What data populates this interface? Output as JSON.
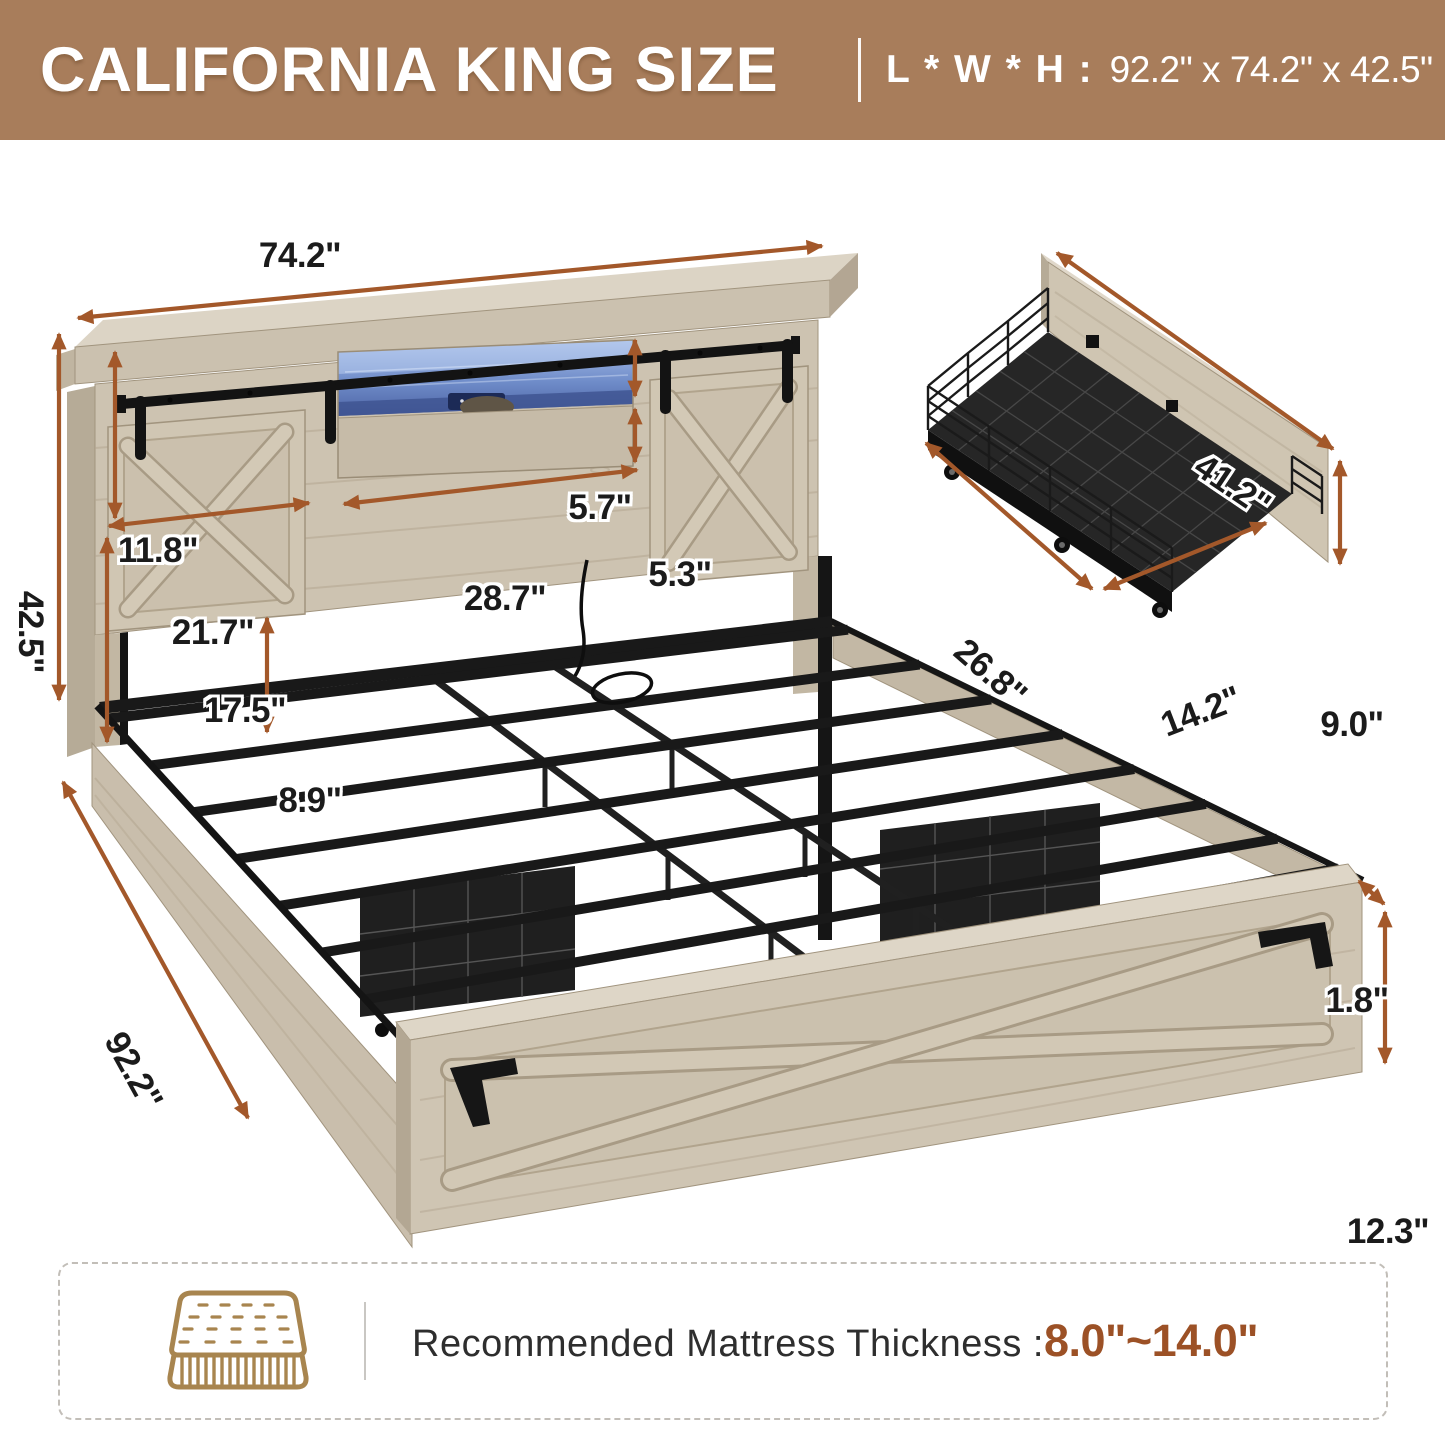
{
  "header": {
    "title": "CALIFORNIA KING SIZE",
    "lwh_label": "L * W * H :",
    "lwh_value": "92.2\" x 74.2\" x 42.5\"",
    "bg_color": "#A87D5B"
  },
  "dimensions": {
    "headboard_width": "74.2\"",
    "total_height": "42.5\"",
    "door_panel_height": "11.8\"",
    "shelf_opening_height": "5.7\"",
    "drawer_front_height": "5.3\"",
    "shelf_opening_width": "28.7\"",
    "door_panel_width": "21.7\"",
    "headboard_lower_height": "17.5\"",
    "underbed_clearance": "8.9\"",
    "bed_length": "92.2\"",
    "footboard_lip": "1.8\"",
    "footboard_height": "12.3\""
  },
  "inset_dimensions": {
    "panel_length": "41.2\"",
    "drawer_depth": "26.8\"",
    "drawer_width": "14.2\"",
    "panel_height": "9.0\""
  },
  "footer": {
    "icon": "mattress-icon",
    "label": "Recommended Mattress Thickness : ",
    "value": "8.0\"~14.0\""
  },
  "colors": {
    "arrow": "#A3582A",
    "accent_value": "#9C5126",
    "wood": "#CBC1AF",
    "wood_dark": "#B6AB97",
    "wood_light": "#DED6C7",
    "metal": "#1B1B1B",
    "led_blue": "#7E9CD6",
    "icon_tan": "#A8854F"
  }
}
